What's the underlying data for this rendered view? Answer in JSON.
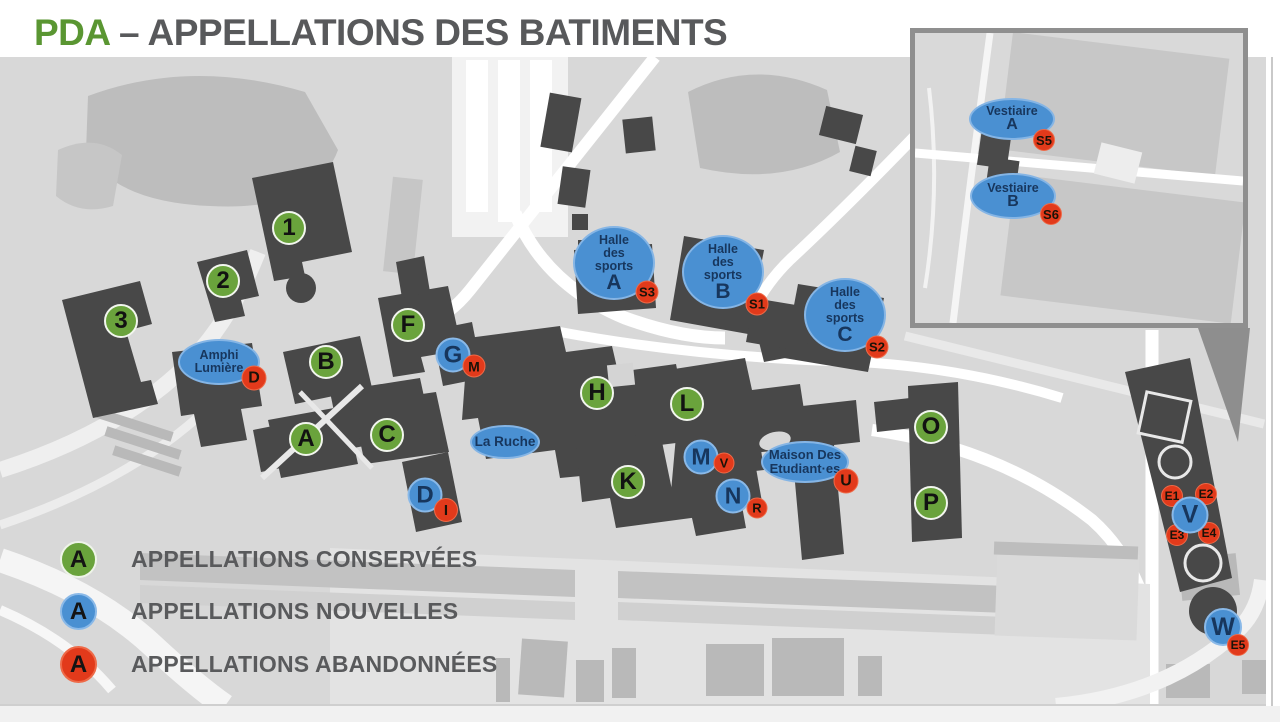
{
  "title": {
    "green": "PDA",
    "gray": "– APPELLATIONS DES BATIMENTS"
  },
  "colors": {
    "conserved_green": "#6aa33c",
    "new_blue": "#4a90d2",
    "abandoned_red": "#e23a1b",
    "marker_text_navy": "#17365d",
    "title_green": "#5a9632",
    "title_gray": "#58595b",
    "map_light_gray": "#d8d8d8",
    "map_medium_gray": "#bdbdbd",
    "building_dark_gray": "#484848"
  },
  "legend": {
    "items": [
      {
        "symbol": "A",
        "type": "green",
        "label": "APPELLATIONS CONSERVÉES"
      },
      {
        "symbol": "A",
        "type": "blue",
        "label": "APPELLATIONS NOUVELLES"
      },
      {
        "symbol": "A",
        "type": "red",
        "label": "APPELLATIONS ABANDONNÉES"
      }
    ]
  },
  "map": {
    "markers": [
      {
        "id": "amphi-lumiere",
        "type": "ellipse",
        "lines": [
          "Amphi",
          "Lumière"
        ],
        "x": 219,
        "y": 362,
        "w": 82,
        "h": 46,
        "fs": 12.5
      },
      {
        "id": "la-ruche",
        "type": "ellipse",
        "lines": [
          "La Ruche"
        ],
        "x": 505,
        "y": 442,
        "w": 70,
        "h": 34,
        "fs": 13.5
      },
      {
        "id": "halle-des-sports-a",
        "type": "ellipse",
        "lines": [
          "Halle",
          "des",
          "sports"
        ],
        "big": "A",
        "x": 614,
        "y": 263,
        "w": 82,
        "h": 74,
        "fs": 12.5,
        "bfs": 21
      },
      {
        "id": "halle-des-sports-b",
        "type": "ellipse",
        "lines": [
          "Halle",
          "des",
          "sports"
        ],
        "big": "B",
        "x": 723,
        "y": 272,
        "w": 82,
        "h": 74,
        "fs": 12.5,
        "bfs": 21
      },
      {
        "id": "halle-des-sports-c",
        "type": "ellipse",
        "lines": [
          "Halle",
          "des",
          "sports"
        ],
        "big": "C",
        "x": 845,
        "y": 315,
        "w": 82,
        "h": 74,
        "fs": 12.5,
        "bfs": 21
      },
      {
        "id": "maison-des-etudiantes",
        "type": "ellipse",
        "lines": [
          "Maison Des",
          "Etudiant·es"
        ],
        "x": 805,
        "y": 462,
        "w": 88,
        "h": 42,
        "fs": 13
      },
      {
        "id": "vestiaire-a",
        "type": "ellipse",
        "lines": [
          "Vestiaire"
        ],
        "big": "A",
        "x": 1012,
        "y": 119,
        "w": 86,
        "h": 42,
        "fs": 12.5,
        "bfs": 16
      },
      {
        "id": "vestiaire-b",
        "type": "ellipse",
        "lines": [
          "Vestiaire"
        ],
        "big": "B",
        "x": 1013,
        "y": 196,
        "w": 86,
        "h": 46,
        "fs": 12.5,
        "bfs": 16
      },
      {
        "id": "green-1",
        "type": "green",
        "label": "1",
        "x": 289,
        "y": 228,
        "d": 34,
        "fs": 24
      },
      {
        "id": "green-2",
        "type": "green",
        "label": "2",
        "x": 223,
        "y": 281,
        "d": 34,
        "fs": 24
      },
      {
        "id": "green-3",
        "type": "green",
        "label": "3",
        "x": 121,
        "y": 321,
        "d": 34,
        "fs": 24
      },
      {
        "id": "green-F",
        "type": "green",
        "label": "F",
        "x": 408,
        "y": 325,
        "d": 34,
        "fs": 24
      },
      {
        "id": "green-B",
        "type": "green",
        "label": "B",
        "x": 326,
        "y": 362,
        "d": 34,
        "fs": 24
      },
      {
        "id": "green-H",
        "type": "green",
        "label": "H",
        "x": 597,
        "y": 393,
        "d": 34,
        "fs": 24
      },
      {
        "id": "green-L",
        "type": "green",
        "label": "L",
        "x": 687,
        "y": 404,
        "d": 34,
        "fs": 24
      },
      {
        "id": "green-A",
        "type": "green",
        "label": "A",
        "x": 306,
        "y": 439,
        "d": 34,
        "fs": 24
      },
      {
        "id": "green-C",
        "type": "green",
        "label": "C",
        "x": 387,
        "y": 435,
        "d": 34,
        "fs": 24
      },
      {
        "id": "green-K",
        "type": "green",
        "label": "K",
        "x": 628,
        "y": 482,
        "d": 34,
        "fs": 24
      },
      {
        "id": "green-O",
        "type": "green",
        "label": "O",
        "x": 931,
        "y": 427,
        "d": 34,
        "fs": 24
      },
      {
        "id": "green-P",
        "type": "green",
        "label": "P",
        "x": 931,
        "y": 503,
        "d": 34,
        "fs": 24
      },
      {
        "id": "blue-G",
        "type": "blue",
        "label": "G",
        "x": 453,
        "y": 355,
        "d": 35,
        "fs": 24
      },
      {
        "id": "blue-M",
        "type": "blue",
        "label": "M",
        "x": 701,
        "y": 457,
        "d": 35,
        "fs": 23
      },
      {
        "id": "blue-N",
        "type": "blue",
        "label": "N",
        "x": 733,
        "y": 496,
        "d": 35,
        "fs": 23
      },
      {
        "id": "blue-D",
        "type": "blue",
        "label": "D",
        "x": 425,
        "y": 495,
        "d": 35,
        "fs": 24
      },
      {
        "id": "blue-V",
        "type": "blue",
        "label": "V",
        "x": 1190,
        "y": 515,
        "d": 37,
        "fs": 25,
        "z": 7
      },
      {
        "id": "blue-W",
        "type": "blue",
        "label": "W",
        "x": 1223,
        "y": 627,
        "d": 38,
        "fs": 25,
        "z": 7
      },
      {
        "id": "red-D",
        "type": "red",
        "label": "D",
        "x": 254,
        "y": 378,
        "d": 25,
        "fs": 16
      },
      {
        "id": "red-M",
        "type": "red",
        "label": "M",
        "x": 474,
        "y": 366,
        "d": 23,
        "fs": 14
      },
      {
        "id": "red-S3",
        "type": "red",
        "label": "S3",
        "x": 647,
        "y": 292,
        "d": 23,
        "fs": 13
      },
      {
        "id": "red-S1",
        "type": "red",
        "label": "S1",
        "x": 757,
        "y": 304,
        "d": 23,
        "fs": 13
      },
      {
        "id": "red-S2",
        "type": "red",
        "label": "S2",
        "x": 877,
        "y": 347,
        "d": 23,
        "fs": 13
      },
      {
        "id": "red-V",
        "type": "red",
        "label": "V",
        "x": 724,
        "y": 463,
        "d": 21,
        "fs": 13
      },
      {
        "id": "red-R",
        "type": "red",
        "label": "R",
        "x": 757,
        "y": 508,
        "d": 21,
        "fs": 13
      },
      {
        "id": "red-I",
        "type": "red",
        "label": "I",
        "x": 446,
        "y": 510,
        "d": 24,
        "fs": 15
      },
      {
        "id": "red-U",
        "type": "red",
        "label": "U",
        "x": 846,
        "y": 481,
        "d": 25,
        "fs": 16
      },
      {
        "id": "red-S5",
        "type": "red",
        "label": "S5",
        "x": 1044,
        "y": 140,
        "d": 22,
        "fs": 13
      },
      {
        "id": "red-S6",
        "type": "red",
        "label": "S6",
        "x": 1051,
        "y": 214,
        "d": 22,
        "fs": 13
      },
      {
        "id": "red-E1",
        "type": "red",
        "label": "E1",
        "x": 1172,
        "y": 496,
        "d": 22,
        "fs": 12
      },
      {
        "id": "red-E2",
        "type": "red",
        "label": "E2",
        "x": 1206,
        "y": 494,
        "d": 22,
        "fs": 12
      },
      {
        "id": "red-E3",
        "type": "red",
        "label": "E3",
        "x": 1177,
        "y": 535,
        "d": 22,
        "fs": 12
      },
      {
        "id": "red-E4",
        "type": "red",
        "label": "E4",
        "x": 1209,
        "y": 533,
        "d": 22,
        "fs": 12
      },
      {
        "id": "red-E5",
        "type": "red",
        "label": "E5",
        "x": 1238,
        "y": 645,
        "d": 22,
        "fs": 12,
        "z": 8
      }
    ]
  }
}
